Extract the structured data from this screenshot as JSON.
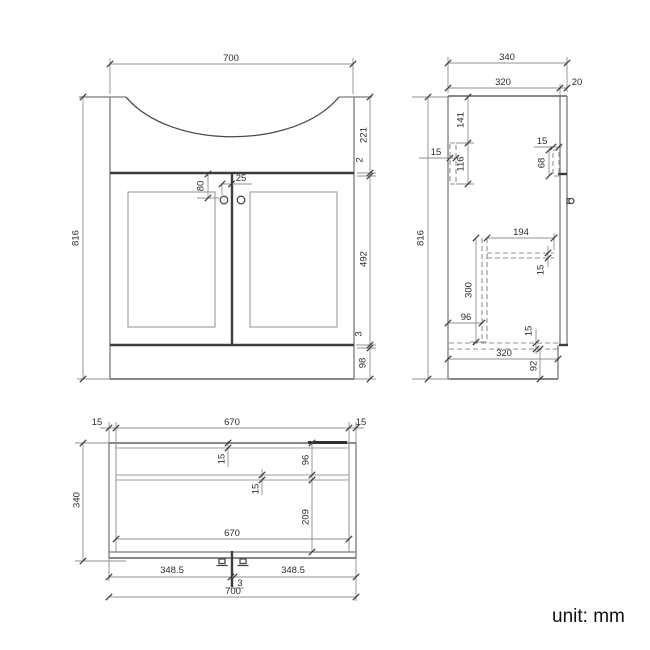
{
  "unit_label": "unit: mm",
  "front": {
    "width": "700",
    "height": "816",
    "basin_height": "221",
    "counter_gap": "2",
    "door_height": "492",
    "bottom_gap": "3",
    "plinth_height": "98",
    "knob_drop": "80",
    "knob_offset": "25"
  },
  "side": {
    "depth": "340",
    "body_depth": "320",
    "door_thickness": "20",
    "height": "816",
    "hinge_top_offset": "141",
    "hinge_width": "15",
    "hinge_height": "116",
    "front_plate_width": "15",
    "front_plate_height": "68",
    "shelf_depth": "194",
    "shelf_thickness": "15",
    "divider_height": "300",
    "divider_offset": "96",
    "bottom_thickness": "15",
    "bottom_depth": "320",
    "plinth_height": "92"
  },
  "plan": {
    "left_wall": "15",
    "inner_width": "670",
    "right_wall": "15",
    "depth": "340",
    "back_thickness": "15",
    "back_offset": "96",
    "shelf_thickness": "15",
    "front_offset": "209",
    "shelf_width": "670",
    "left_door": "348.5",
    "center_gap": "3",
    "right_door": "348.5",
    "width": "700"
  }
}
